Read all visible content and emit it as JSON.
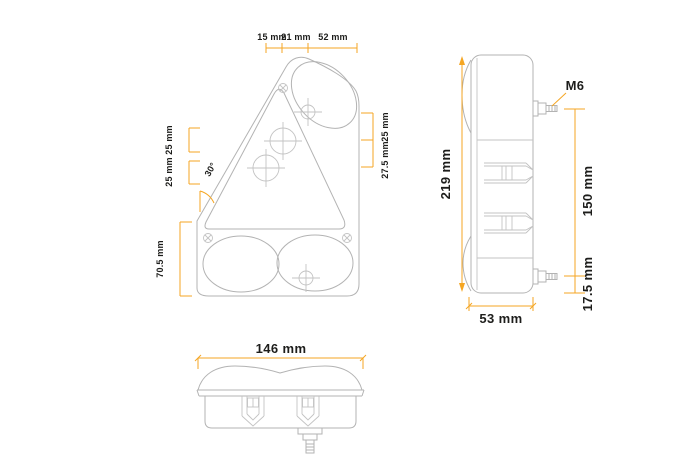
{
  "front": {
    "dim_15": "15 mm",
    "dim_21": "21 mm",
    "dim_52": "52 mm",
    "dim_left_upper": "25 mm",
    "dim_left_lower": "25 mm",
    "dim_left_height": "70.5 mm",
    "dim_right_upper": "25 mm",
    "dim_right_lower": "27.5 mm",
    "angle": "30°"
  },
  "side": {
    "dim_height": "219 mm",
    "bolt": "M6",
    "dim_spacing": "150 mm",
    "dim_offset": "17.5 mm",
    "dim_depth": "53 mm"
  },
  "bottom": {
    "dim_width": "146 mm"
  },
  "colors": {
    "dimension": "#F5A623",
    "linework": "#b3b3b3",
    "text": "#1d1d1b",
    "background": "#ffffff"
  }
}
